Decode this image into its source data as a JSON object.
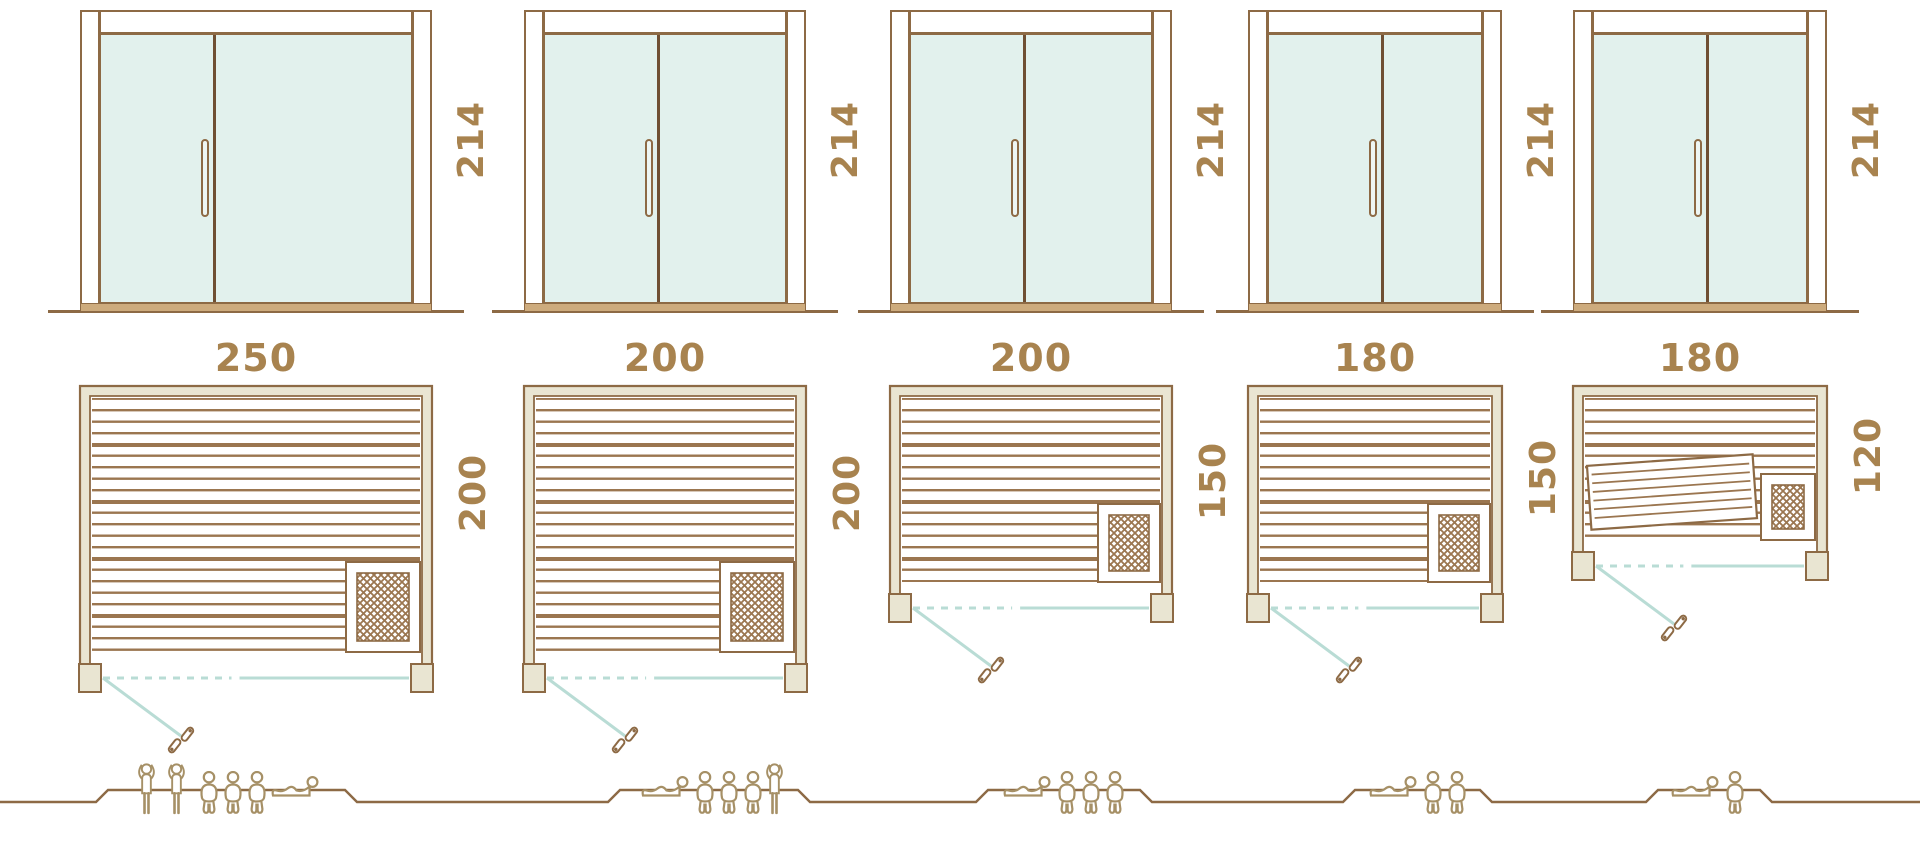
{
  "page": {
    "description": "Sauna cabin size comparison diagram: glass door elevations, floor plans and capacity figures"
  },
  "palette": {
    "outline_brown": "#8d6a45",
    "slat_brown": "#9b7650",
    "dimension_text_brown": "#a8834f",
    "wall_beige": "#e9e5d2",
    "threshold_tan": "#cdab7d",
    "glass_teal": "#e2f1ed",
    "door_swing_teal": "#b9dcd5",
    "people_brown": "#a69066"
  },
  "icons": {
    "people_legend": [
      "standing-person-icon",
      "sitting-person-icon",
      "lying-person-icon"
    ],
    "plan_symbols": [
      "heater-grille-icon",
      "door-swing-arc",
      "door-handle-glyph"
    ]
  },
  "units": [
    {
      "name": "sauna-250x200",
      "door": {
        "height_label": "214"
      },
      "plan": {
        "width_label": "250",
        "depth_label": "200",
        "heater_position": "bottom-right"
      },
      "capacity": {
        "count": 6,
        "people": [
          "standing",
          "standing",
          "sitting",
          "sitting",
          "sitting",
          "lying"
        ]
      }
    },
    {
      "name": "sauna-200x200",
      "door": {
        "height_label": "214"
      },
      "plan": {
        "width_label": "200",
        "depth_label": "200",
        "heater_position": "bottom-right"
      },
      "capacity": {
        "count": 5,
        "people": [
          "lying",
          "sitting",
          "sitting",
          "sitting",
          "standing"
        ]
      }
    },
    {
      "name": "sauna-200x150",
      "door": {
        "height_label": "214"
      },
      "plan": {
        "width_label": "200",
        "depth_label": "150",
        "heater_position": "bottom-right"
      },
      "capacity": {
        "count": 4,
        "people": [
          "lying",
          "sitting",
          "sitting",
          "sitting"
        ]
      }
    },
    {
      "name": "sauna-180x150",
      "door": {
        "height_label": "214"
      },
      "plan": {
        "width_label": "180",
        "depth_label": "150",
        "heater_position": "bottom-right"
      },
      "capacity": {
        "count": 3,
        "people": [
          "lying",
          "sitting",
          "sitting"
        ]
      }
    },
    {
      "name": "sauna-180x120",
      "door": {
        "height_label": "214"
      },
      "plan": {
        "width_label": "180",
        "depth_label": "120",
        "heater_position": "bottom-right",
        "fold_bench": "tilted"
      },
      "capacity": {
        "count": 2,
        "people": [
          "lying",
          "sitting"
        ]
      }
    }
  ]
}
